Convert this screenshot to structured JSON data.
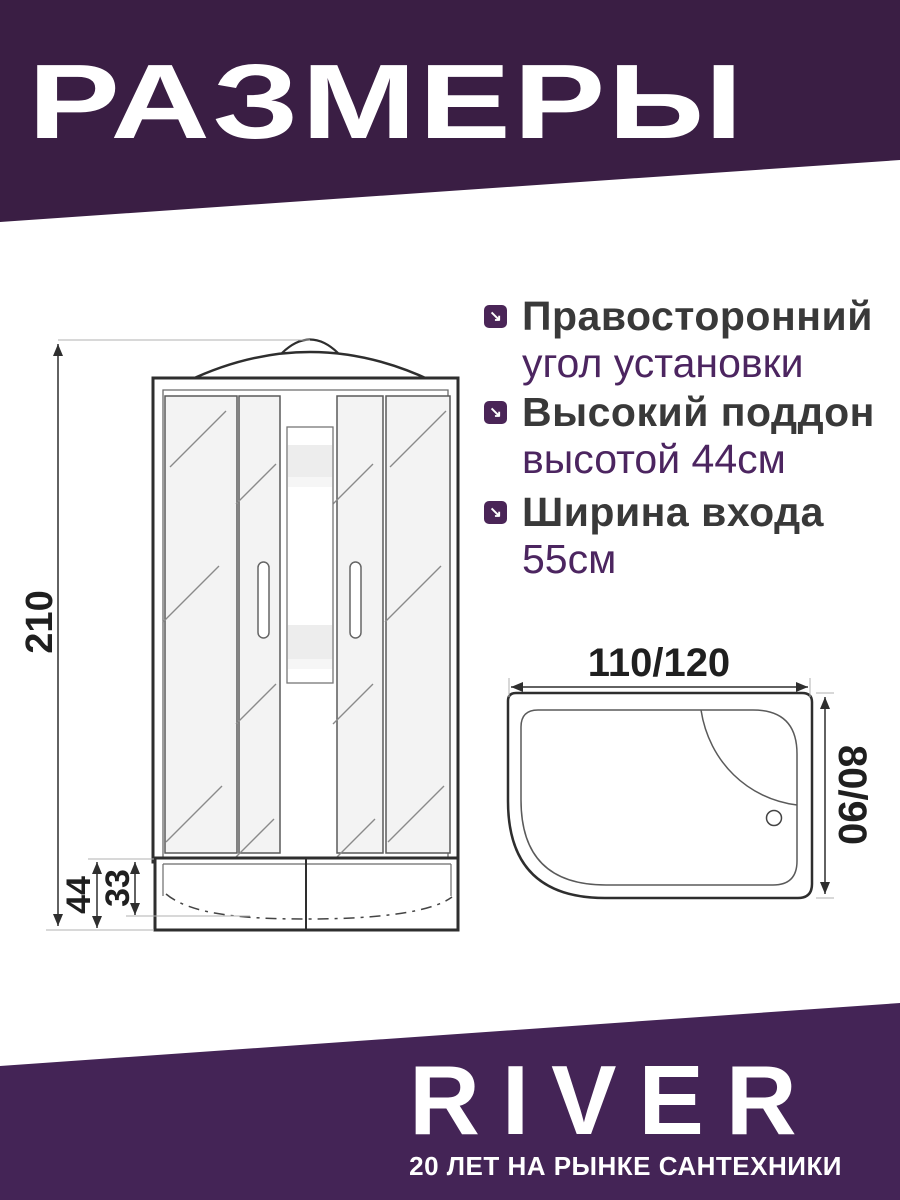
{
  "header": {
    "title": "РАЗМЕРЫ"
  },
  "features": [
    {
      "title": "Правосторонний",
      "subtitle": "угол установки"
    },
    {
      "title": "Высокий поддон",
      "subtitle": "высотой 44см"
    },
    {
      "title": "Ширина входа",
      "subtitle": "55см"
    }
  ],
  "icons": {
    "feature_bullet": "↘"
  },
  "front_view": {
    "height_cm": "210",
    "tray_height_cm": "44",
    "tray_depth_cm": "33"
  },
  "top_view": {
    "width_cm": "110/120",
    "depth_cm": "80/90"
  },
  "footer": {
    "brand": "RIVER",
    "tagline": "20 ЛЕТ НА РЫНКЕ САНТЕХНИКИ"
  },
  "colors": {
    "header_purple": "#3a1e44",
    "footer_purple": "#442456",
    "bullet_purple": "#4a2557",
    "subtitle_purple": "#4c2560",
    "title_gray": "#393939"
  }
}
